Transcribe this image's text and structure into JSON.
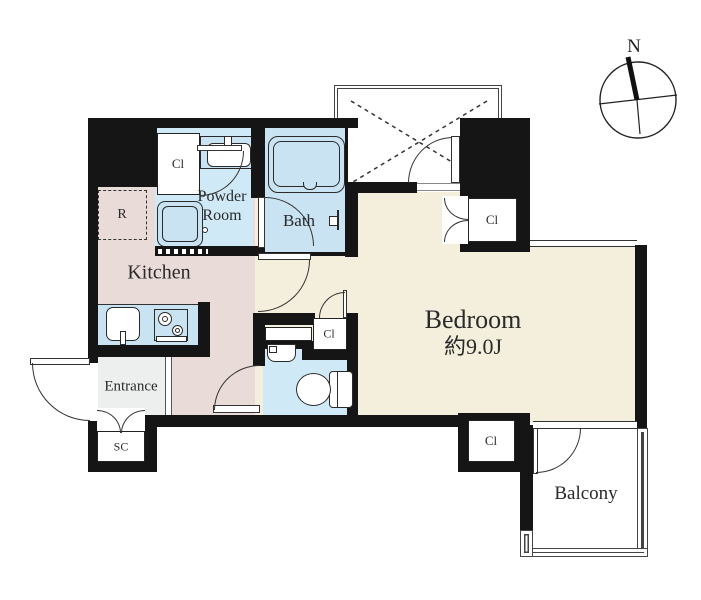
{
  "floorplan": {
    "rooms": {
      "bedroom": {
        "name": "Bedroom",
        "size": "約9.0J"
      },
      "kitchen": {
        "name": "Kitchen"
      },
      "powder_room": {
        "line1": "Powder",
        "line2": "Room"
      },
      "bath": {
        "name": "Bath"
      },
      "entrance": {
        "name": "Entrance"
      },
      "balcony": {
        "name": "Balcony"
      }
    },
    "labels": {
      "closet": "Cl",
      "shoe_closet": "SC",
      "refrigerator": "R"
    },
    "compass": {
      "north": "N"
    },
    "colors": {
      "wall": "#151515",
      "bedroom_floor": "#f3efdc",
      "kitchen_floor": "#e9dbd7",
      "wet_area_floor": "#cfe9f7",
      "fixture_fill": "#c9e3f3",
      "entrance_floor": "#edefef",
      "line": "#333333"
    }
  }
}
